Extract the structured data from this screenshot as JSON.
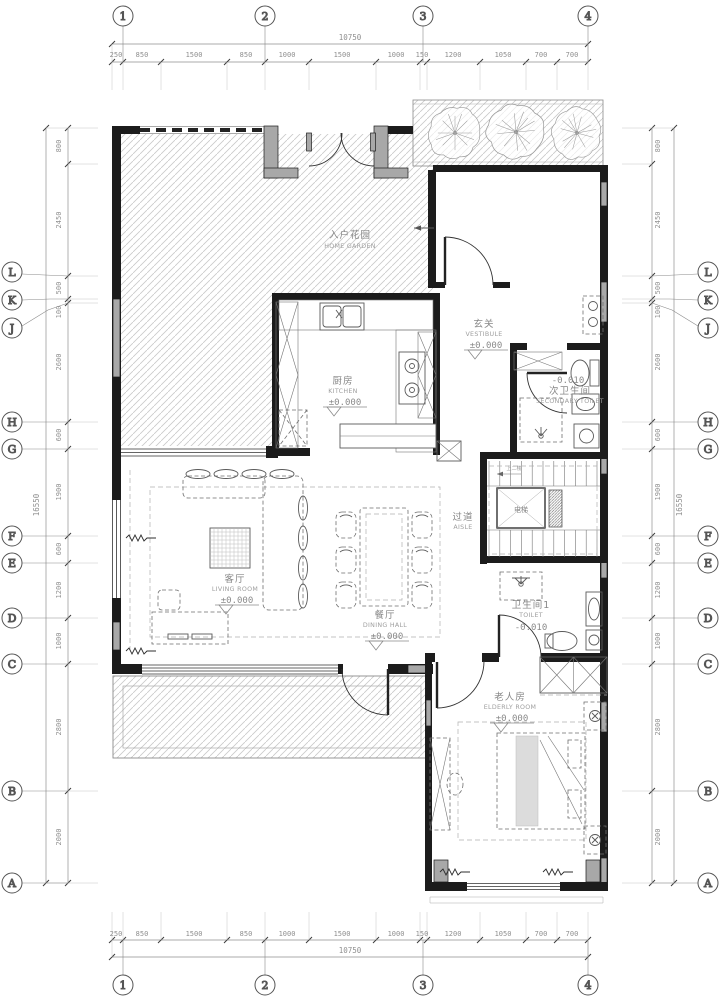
{
  "drawing": {
    "grid": {
      "cols": [
        "1",
        "2",
        "3",
        "4"
      ],
      "rows": [
        "L",
        "K",
        "J",
        "H",
        "G",
        "F",
        "E",
        "D",
        "C",
        "B",
        "A"
      ]
    },
    "dims_h": {
      "overall": "10750",
      "segments": [
        "250",
        "850",
        "1500",
        "850",
        "1000",
        "1500",
        "1000",
        "150",
        "1200",
        "1050",
        "700",
        "700"
      ]
    },
    "dims_v": {
      "overall": "16550",
      "segments": [
        "800",
        "2450",
        "500",
        "100",
        "2600",
        "600",
        "1900",
        "600",
        "1200",
        "1000",
        "2800",
        "2000"
      ]
    },
    "rooms": {
      "home_garden": {
        "cn": "入户花园",
        "en": "HOME GARDEN"
      },
      "kitchen": {
        "cn": "厨房",
        "en": "KITCHEN",
        "level": "±0.000"
      },
      "vestibule": {
        "cn": "玄关",
        "en": "VESTIBULE",
        "level": "±0.000"
      },
      "secondary_toilet": {
        "cn": "次卫生间",
        "en": "SECONDARY TOILET",
        "level": "-0.010"
      },
      "aisle": {
        "cn": "过道",
        "en": "AISLE"
      },
      "elevator": {
        "cn": "电梯"
      },
      "stairs": {
        "note": "上二楼"
      },
      "living_room": {
        "cn": "客厅",
        "en": "LIVING ROOM",
        "level": "±0.000"
      },
      "dining_hall": {
        "cn": "餐厅",
        "en": "DINING HALL",
        "level": "±0.000"
      },
      "toilet1": {
        "cn": "卫生间1",
        "en": "TOILET",
        "level": "-0.010"
      },
      "elderly_room": {
        "cn": "老人房",
        "en": "ELDERLY ROOM",
        "level": "±0.000"
      }
    },
    "colors": {
      "wall": "#1c1c1c",
      "column": "#a8a8a8",
      "hatch": "#c9c9c9",
      "dim_text": "#8f8f8f",
      "label_text": "#878787"
    }
  }
}
